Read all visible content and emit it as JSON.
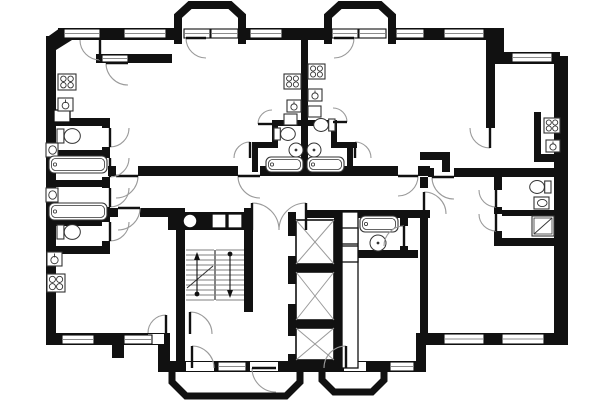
{
  "meta": {
    "title": "architectural-floor-plan",
    "canvas": {
      "w": 600,
      "h": 400
    },
    "colors": {
      "wall": "#111111",
      "fixture": "#333333",
      "arc": "#9a9a9a",
      "window_line": "#666666",
      "bg": "#ffffff"
    }
  },
  "plan": {
    "walls": [
      [
        46,
        36,
        10,
        309
      ],
      [
        58,
        28,
        120,
        12
      ],
      [
        242,
        28,
        88,
        12
      ],
      [
        390,
        28,
        112,
        12
      ],
      [
        492,
        28,
        12,
        36
      ],
      [
        498,
        52,
        62,
        12
      ],
      [
        554,
        56,
        14,
        289
      ],
      [
        46,
        333,
        122,
        12
      ],
      [
        158,
        333,
        12,
        37
      ],
      [
        158,
        361,
        268,
        11
      ],
      [
        416,
        333,
        10,
        39
      ],
      [
        416,
        333,
        152,
        12
      ],
      [
        112,
        345,
        12,
        13
      ],
      [
        96,
        54,
        76,
        9
      ],
      [
        46,
        118,
        62,
        8
      ],
      [
        102,
        118,
        8,
        10
      ],
      [
        102,
        147,
        8,
        11
      ],
      [
        102,
        177,
        8,
        11
      ],
      [
        102,
        207,
        8,
        15
      ],
      [
        102,
        241,
        8,
        11
      ],
      [
        46,
        150,
        56,
        6
      ],
      [
        46,
        180,
        64,
        7
      ],
      [
        46,
        220,
        56,
        6
      ],
      [
        46,
        246,
        64,
        8
      ],
      [
        108,
        166,
        8,
        10
      ],
      [
        138,
        166,
        100,
        10
      ],
      [
        260,
        166,
        138,
        10
      ],
      [
        418,
        166,
        12,
        10
      ],
      [
        428,
        168,
        6,
        9
      ],
      [
        454,
        168,
        114,
        9
      ],
      [
        108,
        208,
        10,
        9
      ],
      [
        140,
        208,
        38,
        9
      ],
      [
        176,
        208,
        9,
        164
      ],
      [
        244,
        208,
        9,
        104
      ],
      [
        168,
        212,
        84,
        18
      ],
      [
        306,
        210,
        124,
        8
      ],
      [
        288,
        212,
        8,
        156
      ],
      [
        334,
        212,
        8,
        156
      ],
      [
        288,
        264,
        54,
        8
      ],
      [
        288,
        320,
        54,
        8
      ],
      [
        288,
        360,
        54,
        8
      ],
      [
        348,
        268,
        9,
        100
      ],
      [
        356,
        250,
        62,
        8
      ],
      [
        400,
        218,
        8,
        8
      ],
      [
        400,
        246,
        8,
        12
      ],
      [
        420,
        177,
        8,
        11
      ],
      [
        420,
        214,
        8,
        119
      ],
      [
        486,
        28,
        9,
        100
      ],
      [
        420,
        152,
        30,
        8
      ],
      [
        442,
        152,
        8,
        20
      ],
      [
        494,
        177,
        8,
        13
      ],
      [
        494,
        207,
        8,
        7
      ],
      [
        494,
        231,
        8,
        13
      ],
      [
        502,
        210,
        54,
        6
      ],
      [
        494,
        238,
        62,
        8
      ],
      [
        534,
        112,
        7,
        50
      ],
      [
        534,
        154,
        24,
        8
      ],
      [
        301,
        40,
        7,
        126
      ],
      [
        252,
        142,
        6,
        30
      ],
      [
        252,
        142,
        26,
        6
      ],
      [
        272,
        120,
        6,
        28
      ],
      [
        272,
        120,
        30,
        6
      ],
      [
        331,
        142,
        26,
        6
      ],
      [
        331,
        120,
        6,
        28
      ],
      [
        307,
        120,
        30,
        6
      ],
      [
        347,
        142,
        6,
        30
      ]
    ],
    "polygons": [
      {
        "points": "46,50 46,38 60,28 72,28 72,40 56,50"
      }
    ],
    "bays": [
      {
        "d": "M 178,44 L 178,16 L 190,5 L 230,5 L 242,16 L 242,44",
        "sw": 8
      },
      {
        "d": "M 328,44 L 328,16 L 340,5 L 380,5 L 392,16 L 392,44",
        "sw": 8
      },
      {
        "d": "M 172,368 L 172,382 L 186,396 L 286,396 L 300,382 L 300,368",
        "sw": 7
      },
      {
        "d": "M 322,368 L 322,380 L 334,392 L 372,392 L 384,380 L 384,368",
        "sw": 7
      }
    ],
    "gaps": [
      [
        148,
        334,
        16,
        10
      ],
      [
        186,
        362,
        28,
        9
      ],
      [
        250,
        362,
        28,
        9
      ],
      [
        344,
        362,
        22,
        9
      ],
      [
        288,
        236,
        8,
        20
      ],
      [
        288,
        284,
        8,
        20
      ],
      [
        288,
        336,
        8,
        18
      ]
    ],
    "windows": [
      [
        64,
        29,
        36,
        9
      ],
      [
        124,
        29,
        42,
        9
      ],
      [
        250,
        29,
        32,
        9
      ],
      [
        396,
        29,
        28,
        9
      ],
      [
        444,
        29,
        40,
        9
      ],
      [
        512,
        53,
        40,
        9
      ],
      [
        184,
        29,
        26,
        9
      ],
      [
        211,
        29,
        27,
        9
      ],
      [
        332,
        29,
        26,
        9
      ],
      [
        359,
        29,
        27,
        9
      ],
      [
        102,
        55,
        26,
        7
      ],
      [
        62,
        335,
        32,
        9
      ],
      [
        124,
        335,
        28,
        9
      ],
      [
        218,
        362,
        28,
        9
      ],
      [
        390,
        362,
        24,
        9
      ],
      [
        444,
        334,
        40,
        10
      ],
      [
        502,
        334,
        42,
        10
      ]
    ],
    "doors": [
      [
        116,
        176,
        22,
        0,
        90
      ],
      [
        260,
        176,
        22,
        180,
        90
      ],
      [
        398,
        176,
        20,
        0,
        90
      ],
      [
        454,
        177,
        22,
        180,
        90
      ],
      [
        118,
        208,
        22,
        0,
        90
      ],
      [
        424,
        214,
        22,
        270,
        0
      ],
      [
        250,
        158,
        16,
        270,
        180
      ],
      [
        272,
        124,
        14,
        180,
        270
      ],
      [
        355,
        158,
        16,
        270,
        0
      ],
      [
        333,
        122,
        14,
        0,
        270
      ],
      [
        100,
        40,
        20,
        90,
        180
      ],
      [
        128,
        63,
        22,
        180,
        90
      ],
      [
        206,
        38,
        20,
        180,
        90
      ],
      [
        334,
        38,
        20,
        0,
        90
      ],
      [
        190,
        334,
        22,
        270,
        0
      ],
      [
        192,
        368,
        22,
        270,
        0
      ],
      [
        276,
        368,
        24,
        180,
        90
      ],
      [
        346,
        368,
        22,
        270,
        180
      ],
      [
        252,
        230,
        27,
        270,
        0
      ],
      [
        306,
        230,
        27,
        270,
        180
      ],
      [
        496,
        190,
        17,
        90,
        180
      ],
      [
        496,
        214,
        17,
        90,
        180
      ],
      [
        490,
        128,
        20,
        90,
        180
      ],
      [
        166,
        333,
        18,
        270,
        180
      ],
      [
        110,
        128,
        19,
        90,
        0
      ],
      [
        110,
        158,
        19,
        90,
        0
      ],
      [
        110,
        188,
        19,
        90,
        0
      ],
      [
        110,
        222,
        19,
        90,
        0
      ],
      [
        404,
        246,
        20,
        270,
        180
      ]
    ],
    "elevators": [
      [
        296,
        220,
        38,
        44
      ],
      [
        296,
        272,
        38,
        48
      ],
      [
        296,
        328,
        38,
        32
      ]
    ],
    "duct_strip": [
      342,
      212,
      16,
      156
    ],
    "boxes": [
      [
        342,
        228,
        16,
        16
      ],
      [
        342,
        246,
        16,
        16
      ],
      [
        212,
        214,
        14,
        14
      ],
      [
        228,
        214,
        14,
        14
      ],
      [
        54,
        110,
        16,
        12
      ]
    ],
    "chute": {
      "cx": 190,
      "cy": 221,
      "r": 7
    },
    "stairs": {
      "x": 186,
      "y": 250,
      "w": 58,
      "h": 50,
      "step": 5,
      "mid": 215,
      "up_x": 197,
      "down_x": 230,
      "break_line": [
        187,
        288,
        213,
        266
      ]
    },
    "fixtures": [
      {
        "t": "stove",
        "x": 58,
        "y": 74,
        "w": 18,
        "h": 16
      },
      {
        "t": "sink",
        "x": 58,
        "y": 98,
        "w": 15,
        "h": 13
      },
      {
        "t": "sinkS",
        "x": 46,
        "y": 143,
        "w": 12,
        "h": 14
      },
      {
        "t": "tub",
        "x": 49,
        "y": 156,
        "w": 58,
        "h": 17
      },
      {
        "t": "sinkS",
        "x": 46,
        "y": 188,
        "w": 12,
        "h": 14
      },
      {
        "t": "tub",
        "x": 49,
        "y": 203,
        "w": 58,
        "h": 17
      },
      {
        "t": "toilet",
        "x": 57,
        "y": 128,
        "w": 23,
        "h": 16,
        "dir": "w"
      },
      {
        "t": "toilet",
        "x": 57,
        "y": 224,
        "w": 23,
        "h": 16,
        "dir": "w"
      },
      {
        "t": "sink",
        "x": 47,
        "y": 252,
        "w": 15,
        "h": 14
      },
      {
        "t": "stove",
        "x": 47,
        "y": 274,
        "w": 18,
        "h": 18
      },
      {
        "t": "stove",
        "x": 284,
        "y": 74,
        "w": 17,
        "h": 15
      },
      {
        "t": "sink",
        "x": 287,
        "y": 100,
        "w": 14,
        "h": 12
      },
      {
        "t": "box",
        "x": 284,
        "y": 114,
        "w": 13,
        "h": 11
      },
      {
        "t": "stove",
        "x": 308,
        "y": 64,
        "w": 17,
        "h": 15
      },
      {
        "t": "sink",
        "x": 308,
        "y": 89,
        "w": 14,
        "h": 12
      },
      {
        "t": "box",
        "x": 308,
        "y": 106,
        "w": 13,
        "h": 11
      },
      {
        "t": "toilet",
        "x": 274,
        "y": 127,
        "w": 21,
        "h": 14,
        "dir": "w"
      },
      {
        "t": "toilet",
        "x": 314,
        "y": 118,
        "w": 21,
        "h": 14,
        "dir": "e"
      },
      {
        "t": "washer",
        "cx": 296,
        "cy": 150,
        "r": 7
      },
      {
        "t": "washer",
        "cx": 314,
        "cy": 150,
        "r": 7
      },
      {
        "t": "tub",
        "x": 266,
        "y": 157,
        "w": 37,
        "h": 15
      },
      {
        "t": "tub",
        "x": 307,
        "y": 157,
        "w": 37,
        "h": 15
      },
      {
        "t": "tub",
        "x": 360,
        "y": 216,
        "w": 38,
        "h": 16
      },
      {
        "t": "washer",
        "cx": 378,
        "cy": 243,
        "r": 8
      },
      {
        "t": "toilet",
        "x": 530,
        "y": 180,
        "w": 21,
        "h": 14,
        "dir": "e"
      },
      {
        "t": "sinkS",
        "x": 534,
        "y": 197,
        "w": 15,
        "h": 12
      },
      {
        "t": "shower",
        "x": 532,
        "y": 216,
        "w": 22,
        "h": 20
      },
      {
        "t": "stove",
        "x": 544,
        "y": 118,
        "w": 16,
        "h": 15
      },
      {
        "t": "sink",
        "x": 546,
        "y": 140,
        "w": 14,
        "h": 12
      }
    ]
  }
}
